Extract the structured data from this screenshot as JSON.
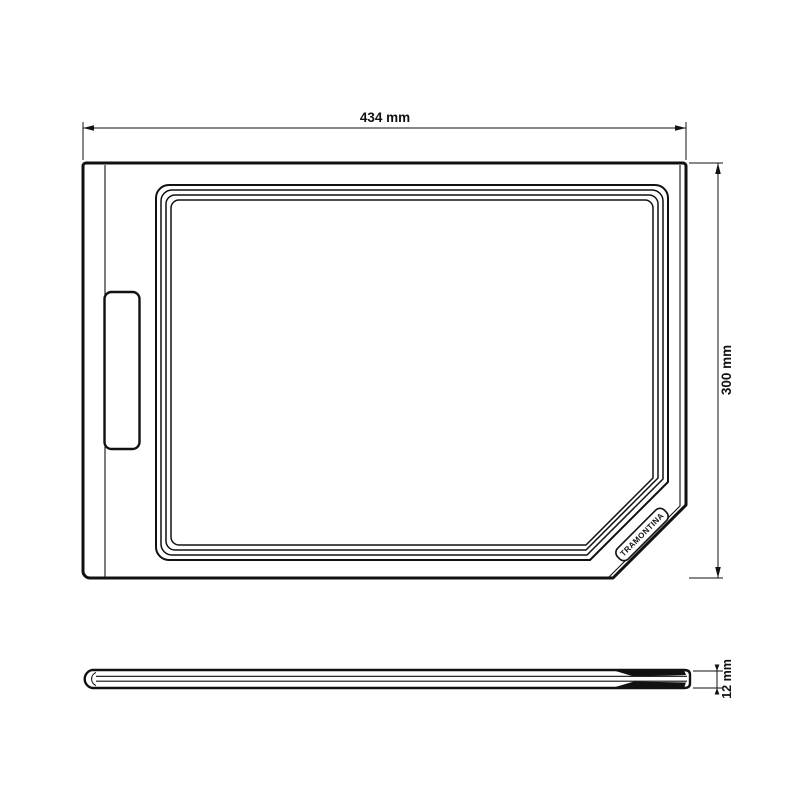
{
  "drawing": {
    "brand_label": "TRAMONTINA",
    "dimensions": {
      "width": {
        "label": "434 mm"
      },
      "height": {
        "label": "300 mm"
      },
      "thickness": {
        "label": "12 mm"
      }
    },
    "colors": {
      "line": "#111111",
      "background": "#ffffff"
    }
  }
}
